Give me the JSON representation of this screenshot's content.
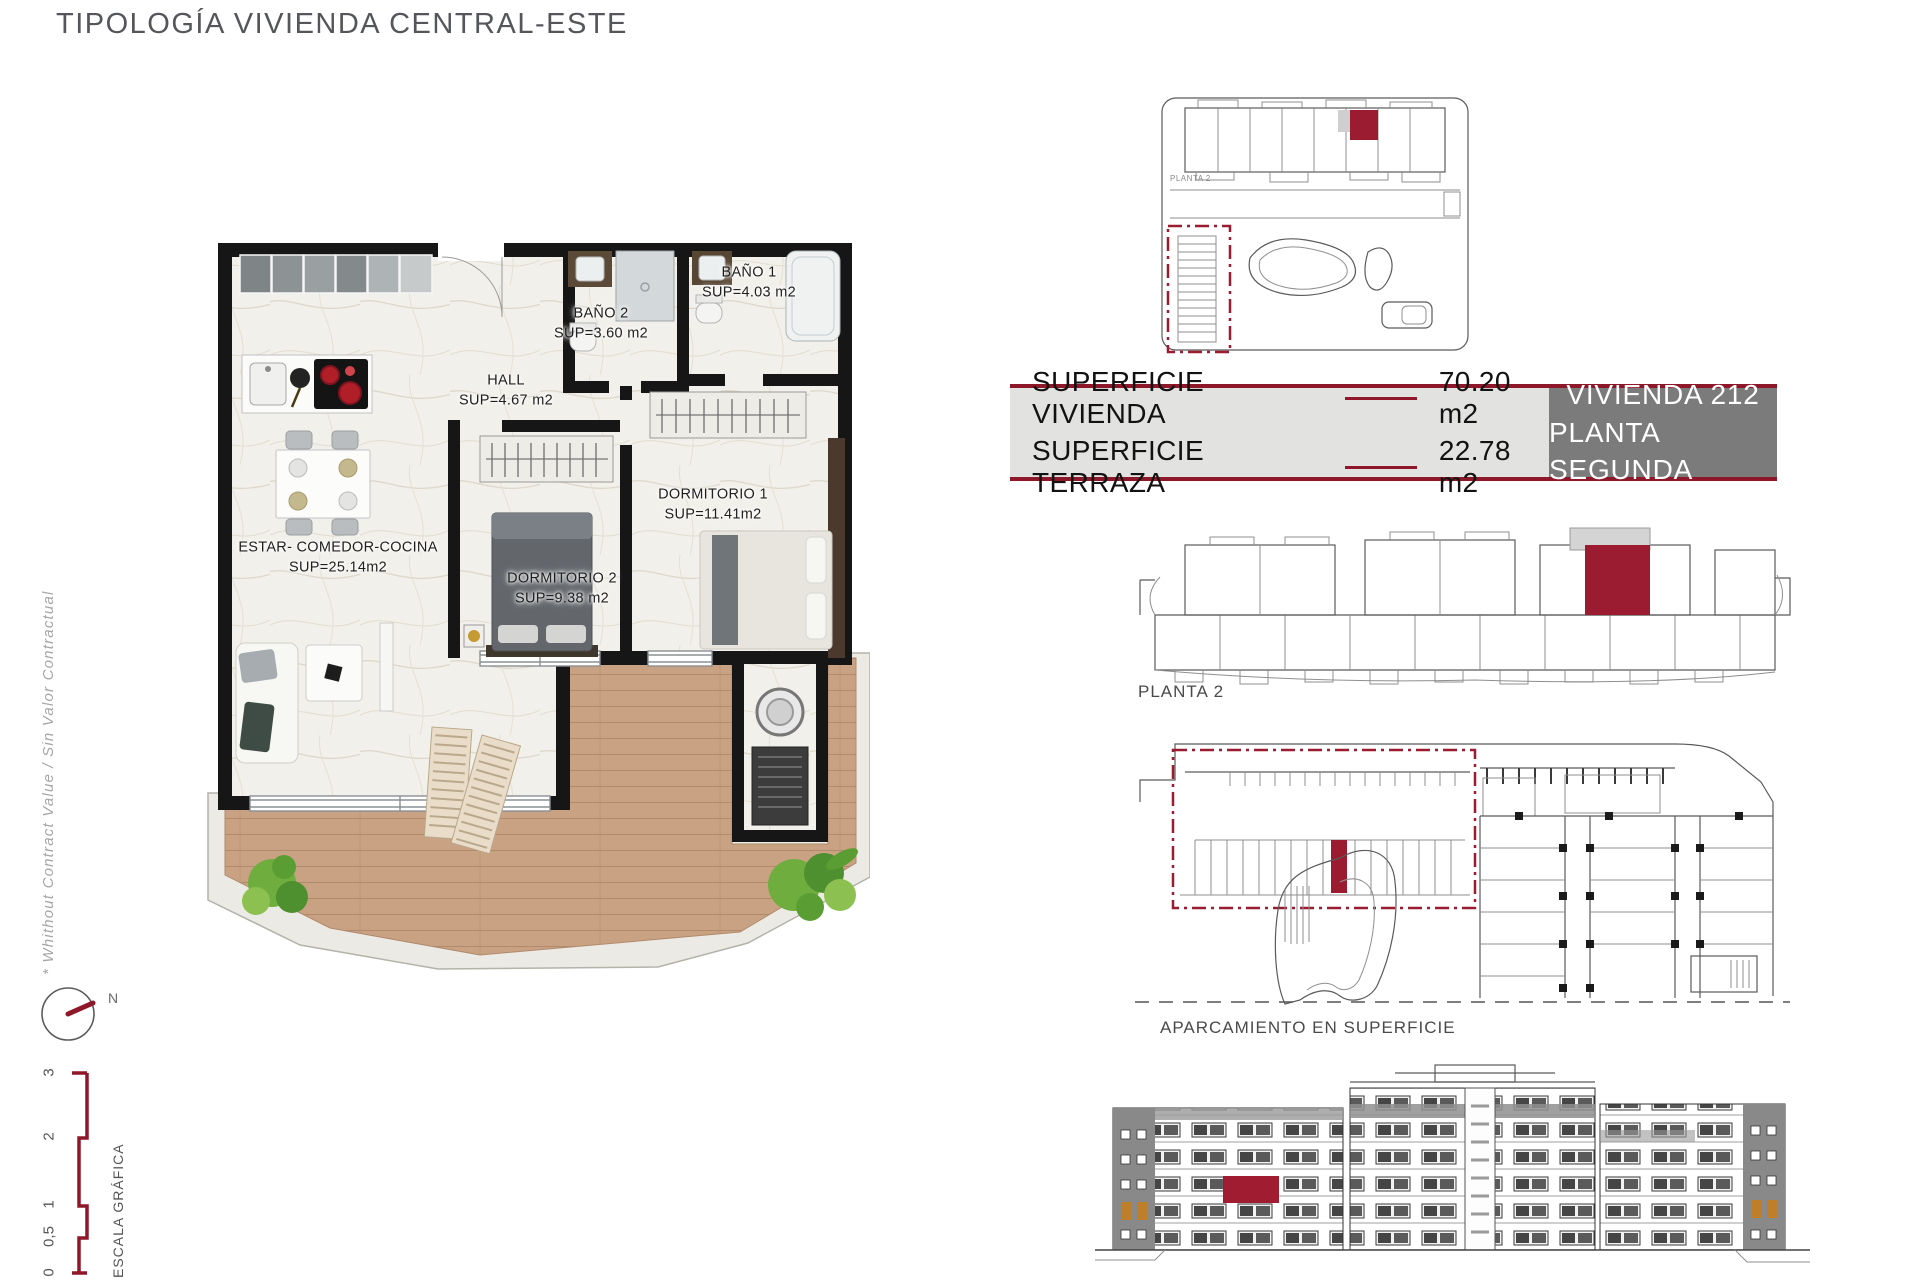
{
  "title": "TIPOLOGÍA VIVIENDA CENTRAL-ESTE",
  "side_note": "* Whithout Contract Value / Sin Valor Contractual",
  "compass": {
    "label": "N"
  },
  "scale_bar": {
    "label": "ESCALA GRÁFICA",
    "ticks": [
      "3",
      "2",
      "1",
      "0,5",
      "0"
    ]
  },
  "floorplan": {
    "rooms": [
      {
        "name": "ESTAR-  COMEDOR-COCINA",
        "area": "SUP=25.14m2"
      },
      {
        "name": "HALL",
        "area": "SUP=4.67  m2"
      },
      {
        "name": "BAÑO  2",
        "area": "SUP=3.60  m2"
      },
      {
        "name": "BAÑO  1",
        "area": "SUP=4.03  m2"
      },
      {
        "name": "DORMITORIO  1",
        "area": "SUP=11.41m2"
      },
      {
        "name": "DORMITORIO  2",
        "area": "SUP=9.38  m2"
      }
    ]
  },
  "info_table": {
    "rows": [
      {
        "label": "SUPERFICIE VIVIENDA",
        "value": "70.20 m2"
      },
      {
        "label": "SUPERFICIE TERRAZA",
        "value": "22.78 m2"
      }
    ],
    "unit": {
      "line1": "VIVIENDA 212",
      "line2": "PLANTA SEGUNDA"
    }
  },
  "diagrams": {
    "siteplan_label": "PLANTA 2",
    "planta2_label": "PLANTA 2",
    "parking_label": "APARCAMIENTO EN SUPERFICIE"
  },
  "colors": {
    "accent": "#9B1B30",
    "table_border": "#8E1729",
    "unit_box_bg": "#7B7B7B"
  }
}
